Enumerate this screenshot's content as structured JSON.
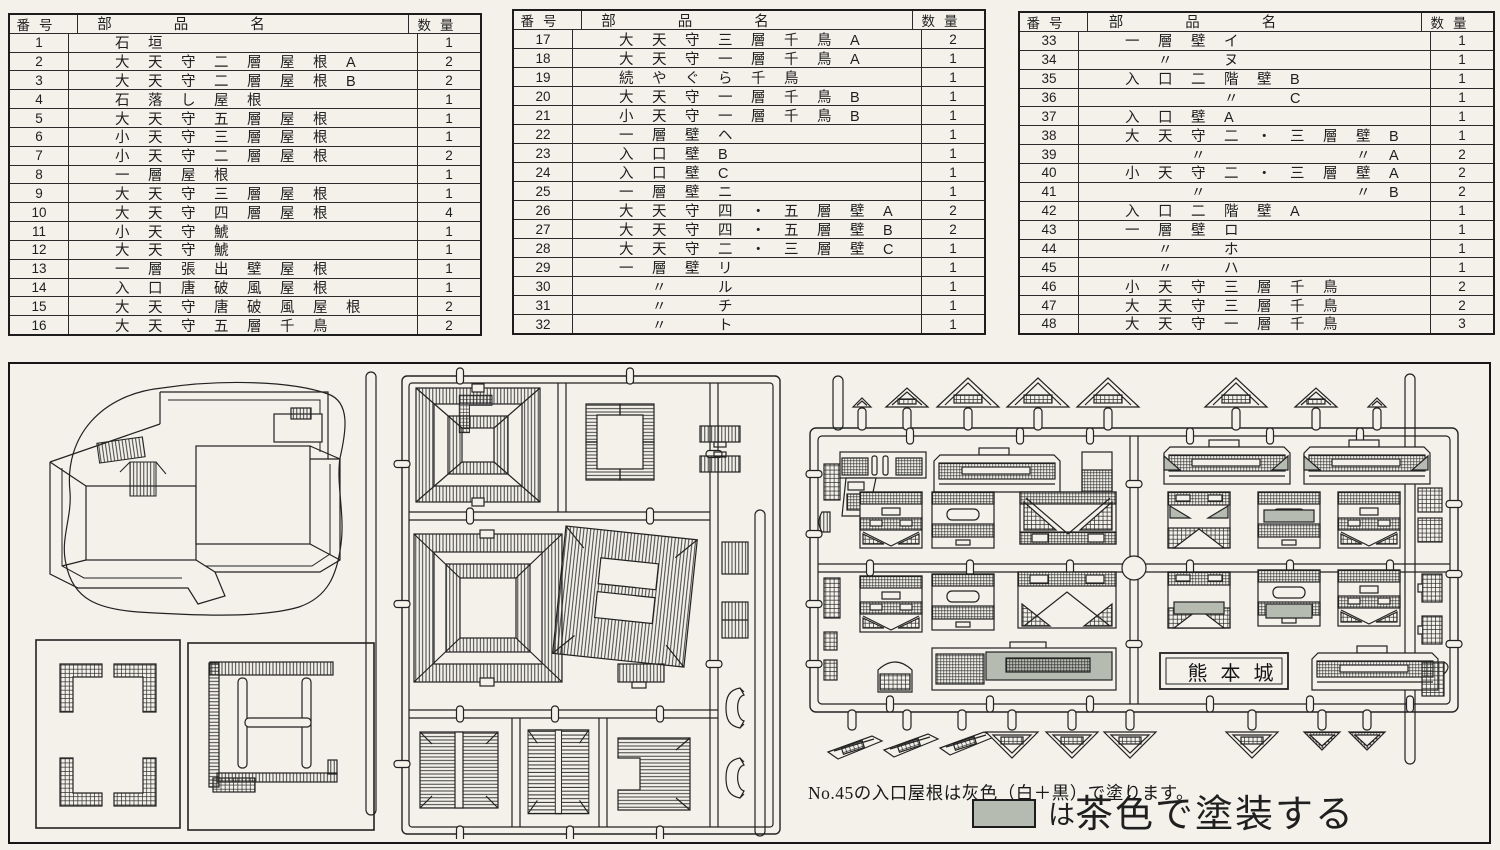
{
  "colors": {
    "paper": "#f3f1ea",
    "ink": "#1f1f1f",
    "paint_gray": "#b5bbb1"
  },
  "parts_list": {
    "headers": {
      "no": "番号",
      "name": "部品名",
      "qty": "数量"
    },
    "tables": [
      {
        "rows": [
          {
            "no": "1",
            "name": "石垣",
            "qty": "1"
          },
          {
            "no": "2",
            "name": "大天守二層屋根A",
            "qty": "2"
          },
          {
            "no": "3",
            "name": "大天守二層屋根B",
            "qty": "2"
          },
          {
            "no": "4",
            "name": "石落し屋根",
            "qty": "1"
          },
          {
            "no": "5",
            "name": "大天守五層屋根",
            "qty": "1"
          },
          {
            "no": "6",
            "name": "小天守三層屋根",
            "qty": "1"
          },
          {
            "no": "7",
            "name": "小天守二層屋根",
            "qty": "2"
          },
          {
            "no": "8",
            "name": "一層屋根",
            "qty": "1"
          },
          {
            "no": "9",
            "name": "大天守三層屋根",
            "qty": "1"
          },
          {
            "no": "10",
            "name": "大天守四層屋根",
            "qty": "4"
          },
          {
            "no": "11",
            "name": "小天守鯱",
            "qty": "1"
          },
          {
            "no": "12",
            "name": "大天守鯱",
            "qty": "1"
          },
          {
            "no": "13",
            "name": "一層張出壁屋根",
            "qty": "1"
          },
          {
            "no": "14",
            "name": "入口唐破風屋根",
            "qty": "1"
          },
          {
            "no": "15",
            "name": "大天守唐破風屋根",
            "qty": "2"
          },
          {
            "no": "16",
            "name": "大天守五層千鳥",
            "qty": "2"
          }
        ]
      },
      {
        "rows": [
          {
            "no": "17",
            "name": "大天守三層千鳥A",
            "qty": "2"
          },
          {
            "no": "18",
            "name": "大天守一層千鳥A",
            "qty": "1"
          },
          {
            "no": "19",
            "name": "続やぐら千鳥",
            "qty": "1"
          },
          {
            "no": "20",
            "name": "大天守一層千鳥B",
            "qty": "1"
          },
          {
            "no": "21",
            "name": "小天守一層千鳥B",
            "qty": "1"
          },
          {
            "no": "22",
            "name": "一層壁ヘ",
            "qty": "1"
          },
          {
            "no": "23",
            "name": "入口壁B",
            "qty": "1"
          },
          {
            "no": "24",
            "name": "入口壁C",
            "qty": "1"
          },
          {
            "no": "25",
            "name": "一層壁ニ",
            "qty": "1"
          },
          {
            "no": "26",
            "name": "大天守四・五層壁A",
            "qty": "2"
          },
          {
            "no": "27",
            "name": "大天守四・五層壁B",
            "qty": "2"
          },
          {
            "no": "28",
            "name": "大天守二・三層壁C",
            "qty": "1"
          },
          {
            "no": "29",
            "name": "一層壁リ",
            "qty": "1"
          },
          {
            "no": "30",
            "name": "　〃　ル",
            "qty": "1"
          },
          {
            "no": "31",
            "name": "　〃　チ",
            "qty": "1"
          },
          {
            "no": "32",
            "name": "　〃　ト",
            "qty": "1"
          }
        ]
      },
      {
        "rows": [
          {
            "no": "33",
            "name": "一層壁イ",
            "qty": "1"
          },
          {
            "no": "34",
            "name": "　〃　ヌ",
            "qty": "1"
          },
          {
            "no": "35",
            "name": "入口二階壁B",
            "qty": "1"
          },
          {
            "no": "36",
            "name": "　　　〃　C",
            "qty": "1"
          },
          {
            "no": "37",
            "name": "入口壁A",
            "qty": "1"
          },
          {
            "no": "38",
            "name": "大天守二・三層壁B",
            "qty": "1"
          },
          {
            "no": "39",
            "name": "　　〃　　　　〃A",
            "qty": "2"
          },
          {
            "no": "40",
            "name": "小天守二・三層壁A",
            "qty": "2"
          },
          {
            "no": "41",
            "name": "　　〃　　　　〃B",
            "qty": "2"
          },
          {
            "no": "42",
            "name": "入口二階壁A",
            "qty": "1"
          },
          {
            "no": "43",
            "name": "一層壁ロ",
            "qty": "1"
          },
          {
            "no": "44",
            "name": "　〃　ホ",
            "qty": "1"
          },
          {
            "no": "45",
            "name": "　〃　ハ",
            "qty": "1"
          },
          {
            "no": "46",
            "name": "小天守三層千鳥",
            "qty": "2"
          },
          {
            "no": "47",
            "name": "大天守三層千鳥",
            "qty": "2"
          },
          {
            "no": "48",
            "name": "大天守一層千鳥",
            "qty": "3"
          }
        ]
      }
    ]
  },
  "diagram": {
    "nameplate": "熊本城",
    "paint_note": "No.45の入口屋根は灰色（白＋黒）で塗ります。",
    "legend_particle": "は",
    "legend_text": "茶色で塗装する",
    "legend_swatch_color": "#b5bbb1"
  }
}
